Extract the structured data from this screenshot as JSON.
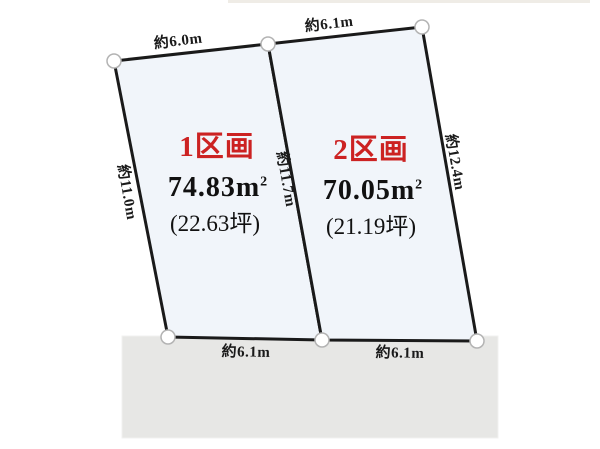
{
  "diagram": {
    "type": "land-parcel-layout",
    "colors": {
      "parcel_fill": "#f1f5fa",
      "outline": "#1a1a1a",
      "road_fill": "#e7e7e5",
      "parcel_name_red": "#cc2222",
      "text": "#1a1a1a",
      "vertex_fill": "#ffffff",
      "vertex_stroke": "#b3b3b3"
    },
    "parcels": [
      {
        "name": "1区画",
        "area_value": "74.83m",
        "area_sup": "2",
        "area_tsubo": "(22.63坪)"
      },
      {
        "name": "2区画",
        "area_value": "70.05m",
        "area_sup": "2",
        "area_tsubo": "(21.19坪)"
      }
    ],
    "dimensions": {
      "top_left_edge": "約6.0m",
      "top_right_edge": "約6.1m",
      "left_edge": "約11.0m",
      "center_boundary": "約11.7m",
      "right_edge": "約12.4m",
      "bottom_left_edge": "約6.1m",
      "bottom_right_edge": "約6.1m"
    }
  }
}
